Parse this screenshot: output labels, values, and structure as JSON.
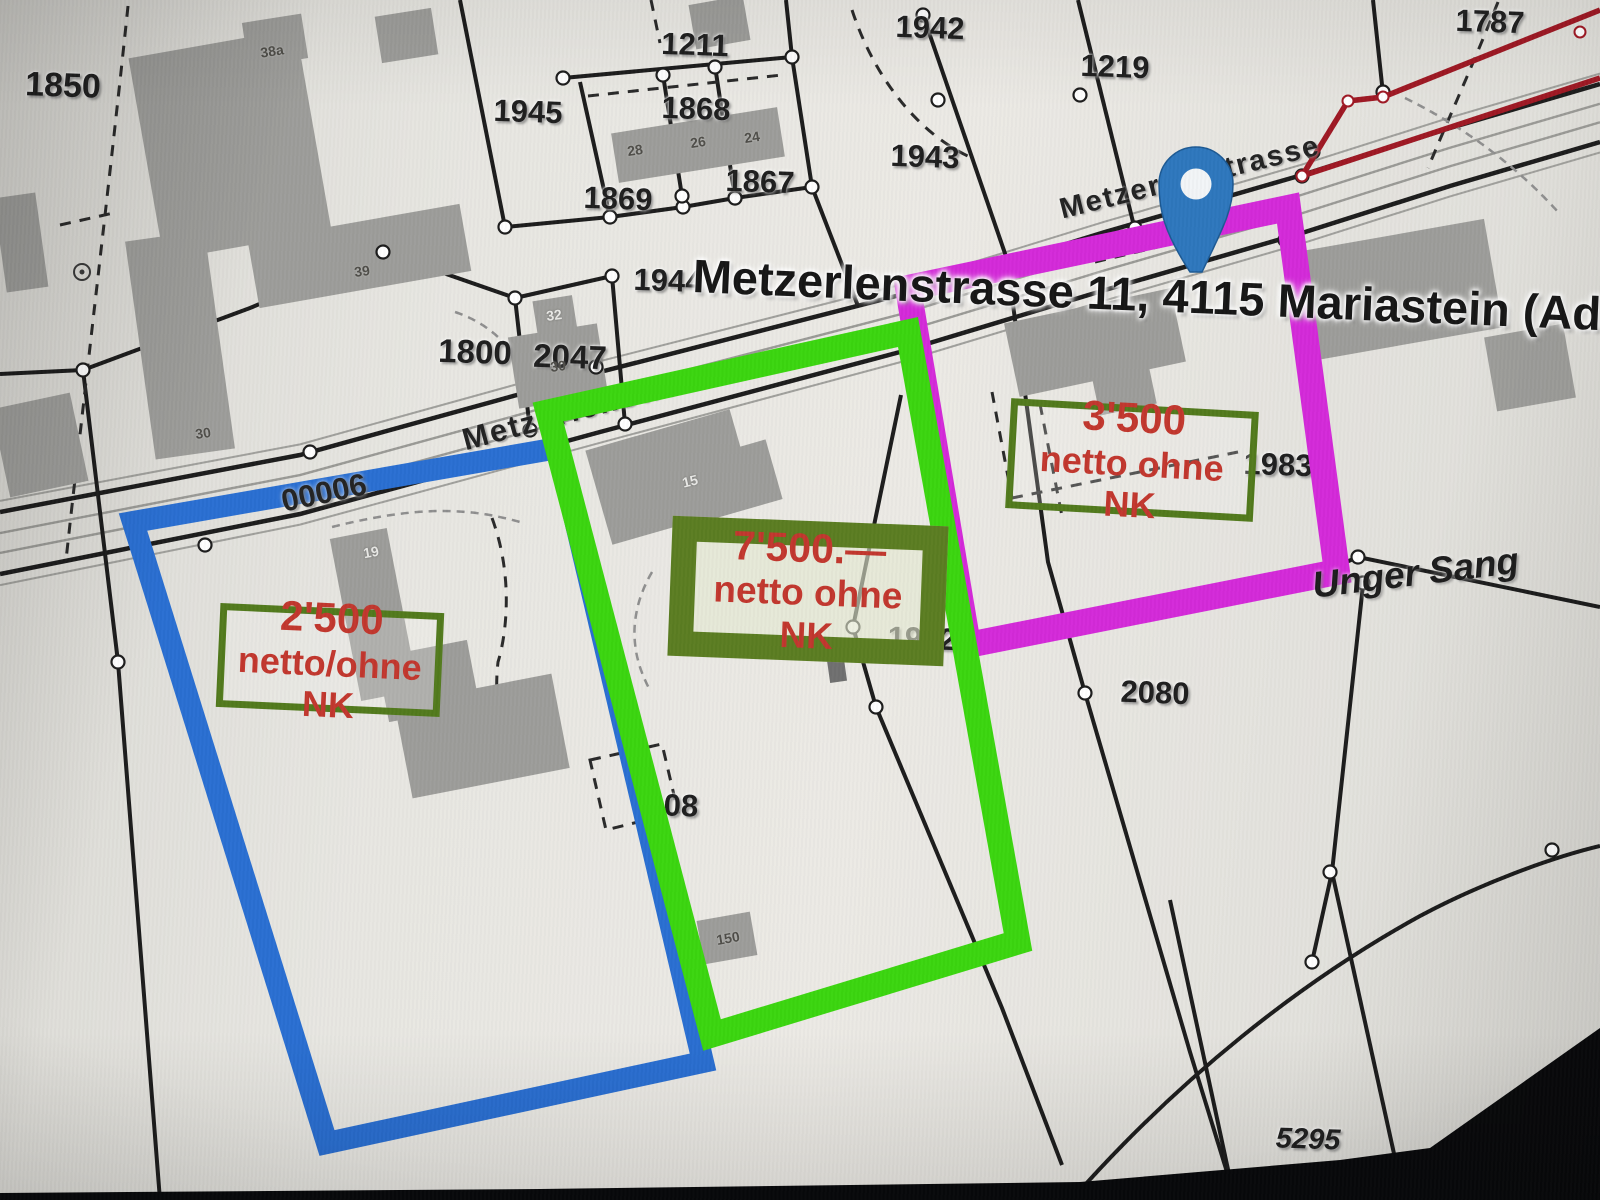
{
  "colors": {
    "paper": "#e7e6e1",
    "building": "#9d9d9a",
    "building_dark": "#707070",
    "boundary": "#1c1c1c",
    "road_gray": "#a0a09c",
    "vertex_fill": "#ffffff",
    "measure_red": "#9f1824",
    "pin_blue": "#2e77bd",
    "pin_stroke": "#1d5a94",
    "pin_hole": "#f2f5f7",
    "price_red": "#c2372e",
    "frame_olive": "#527a1d",
    "frame_olive_thick": "#5b7d22",
    "highlight_blue": "#2a6fd2",
    "highlight_green": "#3bd60f",
    "highlight_magenta": "#d42ad9",
    "bezel": "#08090b"
  },
  "address_overlay": {
    "text": "Metzerlenstrasse 11, 4115 Mariastein (Adresse"
  },
  "area_name": {
    "text": "Unger Sang"
  },
  "road_number": {
    "text": "00006"
  },
  "street_labels": [
    {
      "text": "Metzerlenstrasse",
      "x": 600,
      "y": 404,
      "rot": -15,
      "size": 31
    },
    {
      "text": "Metzerlenstrasse",
      "x": 1190,
      "y": 178,
      "rot": -14,
      "size": 29
    }
  ],
  "parcel_labels": [
    {
      "t": "1850",
      "x": 63,
      "y": 86,
      "size": 34,
      "rot": 2
    },
    {
      "t": "1211",
      "x": 695,
      "y": 45,
      "size": 31,
      "rot": 2
    },
    {
      "t": "1945",
      "x": 528,
      "y": 112,
      "size": 31,
      "rot": 2
    },
    {
      "t": "1868",
      "x": 696,
      "y": 109,
      "size": 31,
      "rot": 2
    },
    {
      "t": "1869",
      "x": 618,
      "y": 199,
      "size": 31,
      "rot": 2
    },
    {
      "t": "1867",
      "x": 760,
      "y": 182,
      "size": 31,
      "rot": 2
    },
    {
      "t": "1944",
      "x": 668,
      "y": 281,
      "size": 31,
      "rot": 2
    },
    {
      "t": "1943",
      "x": 925,
      "y": 157,
      "size": 31,
      "rot": 2
    },
    {
      "t": "1942",
      "x": 930,
      "y": 28,
      "size": 31,
      "rot": 2
    },
    {
      "t": "1219",
      "x": 1115,
      "y": 67,
      "size": 31,
      "rot": 2
    },
    {
      "t": "1787",
      "x": 1490,
      "y": 22,
      "size": 31,
      "rot": 2
    },
    {
      "t": "1800",
      "x": 475,
      "y": 352,
      "size": 33,
      "rot": 2
    },
    {
      "t": "2047",
      "x": 570,
      "y": 357,
      "size": 33,
      "rot": 2
    },
    {
      "t": "1983",
      "x": 1278,
      "y": 465,
      "size": 31,
      "rot": 2
    },
    {
      "t": "2080",
      "x": 1155,
      "y": 693,
      "size": 31,
      "rot": 2
    },
    {
      "t": "5295",
      "x": 1308,
      "y": 1140,
      "size": 29,
      "rot": 2,
      "style": "italic"
    },
    {
      "t": "1962",
      "x": 922,
      "y": 639,
      "size": 31,
      "rot": 2
    },
    {
      "t": "08",
      "x": 681,
      "y": 806,
      "size": 31,
      "rot": 2
    }
  ],
  "building_labels": [
    {
      "t": "38a",
      "x": 272,
      "y": 51,
      "rot": -9,
      "tone": "dark"
    },
    {
      "t": "28",
      "x": 635,
      "y": 150,
      "rot": -9,
      "tone": "dark"
    },
    {
      "t": "26",
      "x": 698,
      "y": 142,
      "rot": -9,
      "tone": "dark"
    },
    {
      "t": "24",
      "x": 752,
      "y": 137,
      "rot": -9,
      "tone": "dark"
    },
    {
      "t": "39",
      "x": 362,
      "y": 271,
      "rot": -8,
      "tone": "dark"
    },
    {
      "t": "30",
      "x": 203,
      "y": 433,
      "rot": -8,
      "tone": "dark"
    },
    {
      "t": "30",
      "x": 558,
      "y": 366,
      "rot": -8,
      "tone": "dark"
    },
    {
      "t": "32",
      "x": 554,
      "y": 315,
      "rot": -8,
      "tone": "light"
    },
    {
      "t": "19",
      "x": 371,
      "y": 552,
      "rot": -10,
      "tone": "light"
    },
    {
      "t": "15",
      "x": 690,
      "y": 481,
      "rot": -14,
      "tone": "light"
    },
    {
      "t": "150",
      "x": 728,
      "y": 938,
      "rot": -10,
      "tone": "dark"
    }
  ],
  "listings": [
    {
      "price": "2'500",
      "terms": "netto/ohne NK",
      "frame": "thin",
      "x": 330,
      "y": 660,
      "w": 224,
      "h": 104,
      "rot": 2.6
    },
    {
      "price": "7'500.—",
      "terms": "netto ohne NK",
      "frame": "thick",
      "x": 808,
      "y": 591,
      "w": 276,
      "h": 140,
      "rot": 2.2
    },
    {
      "price": "3'500",
      "terms": "netto ohne NK",
      "frame": "thin",
      "x": 1132,
      "y": 460,
      "w": 248,
      "h": 110,
      "rot": 3.2
    }
  ],
  "highlights": [
    {
      "name": "parcel-highlight-blue",
      "points": "133,522 558,448 703,1062 327,1143",
      "color": "#2a6fd2",
      "width": 22
    },
    {
      "name": "parcel-highlight-magenta",
      "points": "908,288 1288,208 1337,572 968,645",
      "color": "#d42ad9",
      "width": 26
    },
    {
      "name": "parcel-highlight-green",
      "points": "548,412 908,332 1018,942 712,1035",
      "color": "#3bd60f",
      "width": 25
    }
  ],
  "map_pin": {
    "x": 1196,
    "y": 272,
    "head_x": 1196,
    "head_y": 184,
    "head_r": 37,
    "hole_r": 15.5
  },
  "geometry": {
    "road": {
      "top": [
        [
          0,
          512
        ],
        [
          300,
          455
        ],
        [
          600,
          372
        ],
        [
          900,
          295
        ],
        [
          1105,
          232
        ],
        [
          1302,
          175
        ],
        [
          1450,
          128
        ],
        [
          1600,
          84
        ]
      ],
      "bottom": [
        [
          0,
          574
        ],
        [
          300,
          514
        ],
        [
          600,
          432
        ],
        [
          900,
          352
        ],
        [
          1105,
          290
        ],
        [
          1302,
          233
        ],
        [
          1450,
          186
        ],
        [
          1600,
          142
        ]
      ]
    },
    "solid": [
      "M0,374 L83,370 L250,308 L383,252",
      "M83,370 L118,662 L160,1200",
      "M383,252 L515,298 L612,276",
      "M515,298 L530,430",
      "M612,276 L625,424",
      "M460,0 L505,227",
      "M505,227 L610,217 L683,207 L735,198 L812,187",
      "M563,78 L792,57",
      "M580,82 L610,217",
      "M663,75 L682,196",
      "M715,66 L735,198",
      "M792,57 L812,187",
      "M786,0 L792,57",
      "M812,187 L858,306",
      "M923,15 L1010,268",
      "M1078,0 L1135,230",
      "M1373,0 L1383,94",
      "M901,395 L853,627 L876,707 L1002,1008 L1062,1165",
      "M1008,268 L1048,562 L1085,693",
      "M1085,693 L1190,1052 L1235,1198",
      "M968,648 L1290,586 L1358,557",
      "M1358,557 L1600,607",
      "M1363,585 L1332,872 L1312,962",
      "M1075,1196 C1180,1078 1300,982 1420,916 C1480,884 1550,858 1600,846",
      "M1170,900 L1232,1188",
      "M1332,872 L1402,1190"
    ],
    "dashed_black": [
      "M128,6 C112,160 88,360 66,560",
      "M588,96 L782,75",
      "M651,0 L660,43",
      "M852,10 C875,80 920,135 972,158",
      "M1498,2 C1475,60 1450,115 1428,168",
      "M1012,498 L1238,452",
      "M1040,404 L1062,516",
      "M992,392 L1012,498",
      "M1095,262 L1262,222",
      "M492,518 C515,580 505,640 498,662 C492,715 508,742 518,762",
      "M590,760 L662,744 L678,812 L606,830 Z",
      "M155,258 L318,232",
      "M60,225 L118,212"
    ],
    "dashed_gray": [
      "M455,312 C510,330 535,380 545,426",
      "M332,527 C420,505 470,508 520,522",
      "M1405,98 C1470,130 1520,170 1558,212",
      "M652,572 C630,610 628,650 650,690"
    ],
    "red_path": [
      "M1600,10 L1383,97 L1348,101 L1302,176",
      "M1302,176 L1600,78"
    ],
    "red_dots": [
      [
        1580,
        32
      ],
      [
        1383,
        97
      ],
      [
        1348,
        101
      ],
      [
        1302,
        176
      ]
    ],
    "buildings": [
      [
        145,
        42,
        170,
        205,
        -10
      ],
      [
        252,
        222,
        215,
        68,
        -10
      ],
      [
        245,
        18,
        60,
        45,
        -9
      ],
      [
        378,
        12,
        57,
        47,
        -9
      ],
      [
        692,
        0,
        55,
        45,
        -10
      ],
      [
        0,
        195,
        42,
        95,
        -8
      ],
      [
        0,
        400,
        80,
        90,
        -12
      ],
      [
        140,
        235,
        80,
        220,
        -8
      ],
      [
        614,
        120,
        168,
        50,
        -9
      ],
      [
        535,
        298,
        40,
        36,
        -9
      ],
      [
        513,
        330,
        90,
        72,
        -9
      ],
      [
        345,
        532,
        58,
        165,
        -11
      ],
      [
        382,
        648,
        92,
        66,
        -11
      ],
      [
        402,
        688,
        160,
        96,
        -11
      ],
      [
        596,
        428,
        150,
        98,
        -16
      ],
      [
        676,
        452,
        100,
        62,
        -16
      ],
      [
        828,
        652,
        17,
        30,
        -8,
        "dark"
      ],
      [
        700,
        916,
        54,
        44,
        -10
      ],
      [
        1010,
        305,
        170,
        75,
        -12
      ],
      [
        1095,
        368,
        58,
        42,
        -12
      ],
      [
        1300,
        235,
        195,
        110,
        -10
      ],
      [
        1490,
        330,
        80,
        75,
        -10
      ]
    ],
    "dots": [
      [
        310,
        452
      ],
      [
        497,
        457
      ],
      [
        596,
        367
      ],
      [
        1010,
        268
      ],
      [
        1302,
        176
      ],
      [
        1285,
        240
      ],
      [
        205,
        545
      ],
      [
        1313,
        152
      ],
      [
        383,
        252
      ],
      [
        515,
        298
      ],
      [
        612,
        276
      ],
      [
        530,
        430
      ],
      [
        625,
        424
      ],
      [
        505,
        227
      ],
      [
        610,
        217
      ],
      [
        683,
        207
      ],
      [
        735,
        198
      ],
      [
        812,
        187
      ],
      [
        563,
        78
      ],
      [
        663,
        75
      ],
      [
        715,
        67
      ],
      [
        792,
        57
      ],
      [
        682,
        196
      ],
      [
        735,
        198
      ],
      [
        938,
        100
      ],
      [
        923,
        15
      ],
      [
        1080,
        95
      ],
      [
        1135,
        228
      ],
      [
        1383,
        92
      ],
      [
        853,
        627
      ],
      [
        876,
        707
      ],
      [
        1085,
        693
      ],
      [
        1358,
        557
      ],
      [
        1363,
        583
      ],
      [
        1330,
        872
      ],
      [
        1312,
        962
      ],
      [
        1552,
        850
      ],
      [
        83,
        370
      ],
      [
        118,
        662
      ]
    ],
    "symbol_circle": [
      82,
      272
    ],
    "bezel": "M0,1193 L540,1189 L1080,1182 L1340,1160 L1430,1148 L1600,1028 L1600,1200 L0,1200 Z"
  }
}
